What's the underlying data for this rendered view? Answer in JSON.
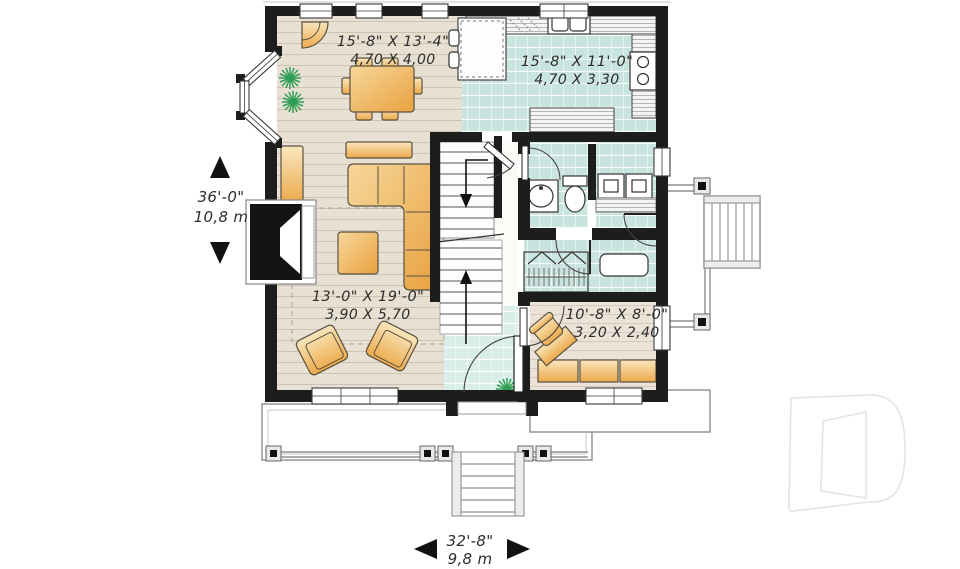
{
  "plan": {
    "type": "house-first-floor-plan",
    "rooms": {
      "dining": {
        "imperial": "15'-8\" X 13'-4\"",
        "metric": "4,70 X 4,00"
      },
      "kitchen": {
        "imperial": "15'-8\" X 11'-0\"",
        "metric": "4,70 X 3,30"
      },
      "living": {
        "imperial": "13'-0\" X 19'-0\"",
        "metric": "3,90 X 5,70"
      },
      "office": {
        "imperial": "10'-8\" X 8'-0\"",
        "metric": "3,20 X 2,40"
      }
    },
    "dimensions": {
      "depth": {
        "imperial": "36'-0\"",
        "metric": "10,8 m"
      },
      "width": {
        "imperial": "32'-8\"",
        "metric": "9,8 m"
      }
    },
    "watermark": {
      "icon": "d-monogram-logo"
    },
    "colors": {
      "wall": "#1d1d1d",
      "wood_floor": "#e8e0d3",
      "office_floor": "#ece3d8",
      "tile_floor": "#c9e4df",
      "foyer_tile": "#d9ede9",
      "furniture_dark": "#eda83f",
      "furniture_light": "#f8e2b4",
      "plant": "#2f9e54",
      "exterior_line": "#8f8f8f",
      "label_text": "#2d2d2d",
      "watermark_outline": "#e4e4e4"
    }
  }
}
